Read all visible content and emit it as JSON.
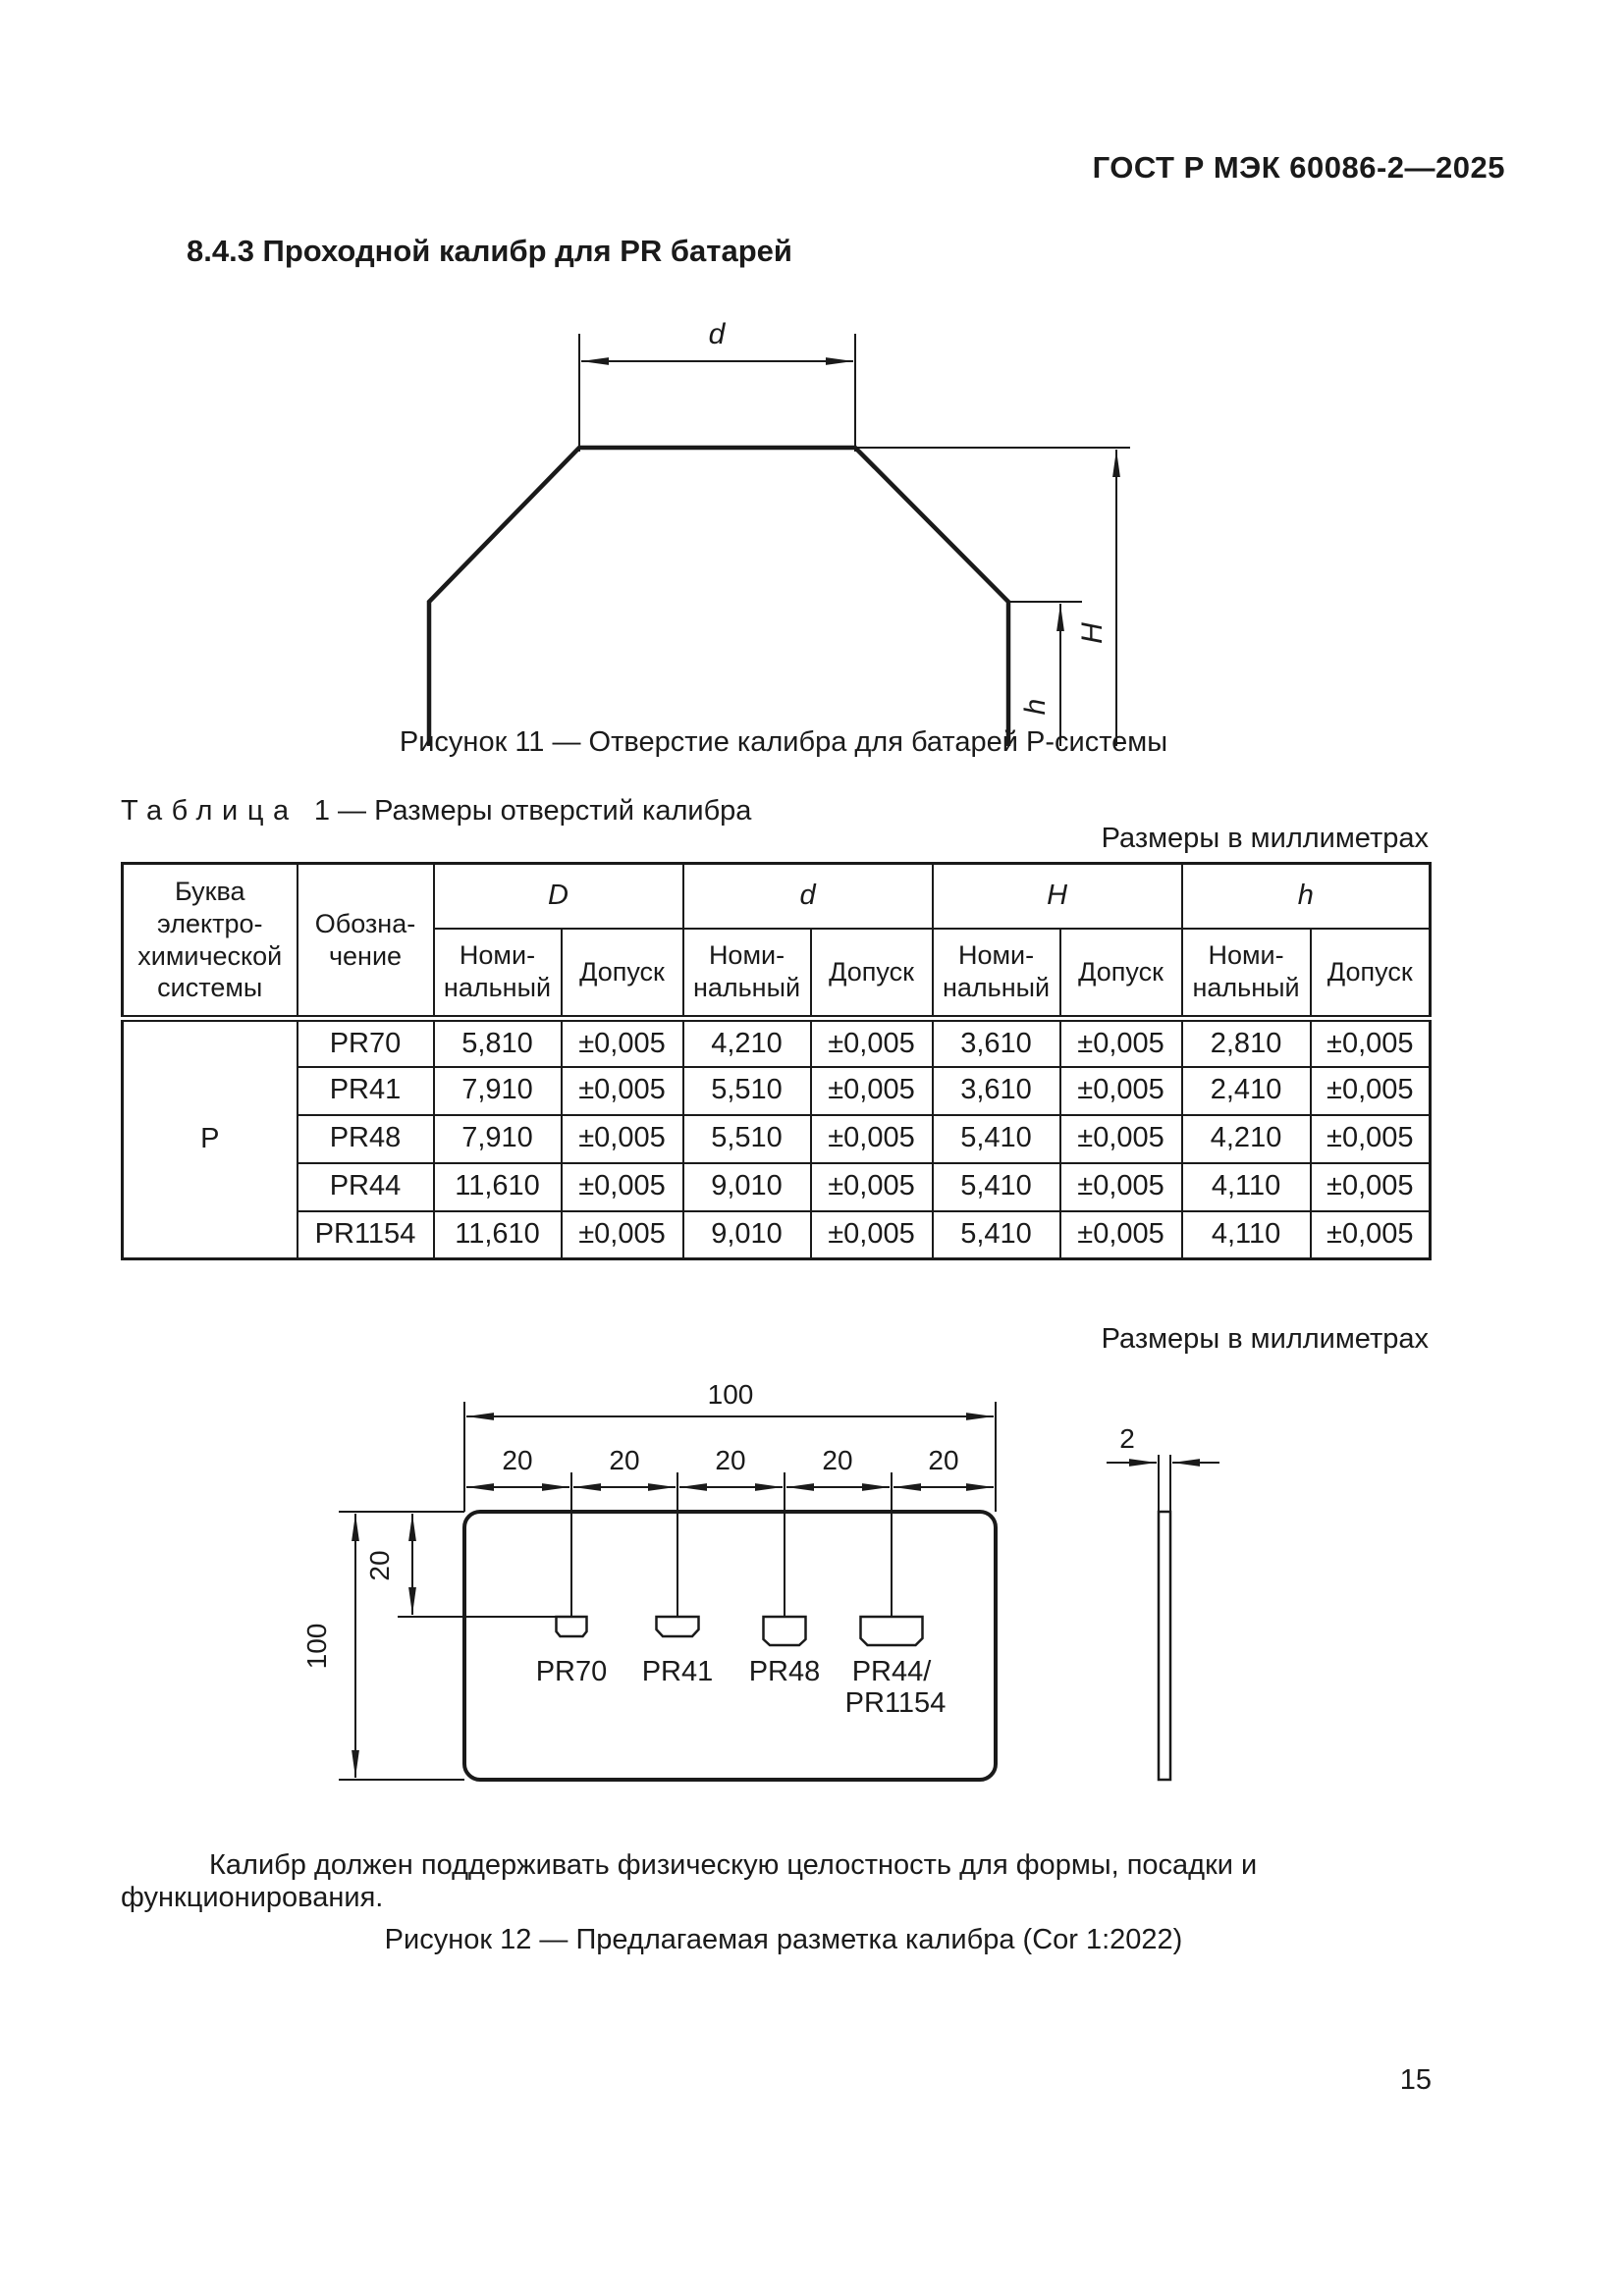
{
  "header": {
    "title": "ГОСТ Р МЭК 60086-2—2025"
  },
  "section": {
    "heading": "8.4.3 Проходной калибр для PR батарей"
  },
  "figure11": {
    "caption": "Рисунок 11 — Отверстие калибра для батарей P-системы",
    "dims": {
      "d": "d",
      "D": "D",
      "H": "H",
      "h": "h"
    }
  },
  "table1": {
    "label": "Таблица",
    "number_and_title": "1 — Размеры отверстий калибра",
    "units_note": "Размеры в миллиметрах",
    "headers": {
      "col_system": "Буква электро-\nхимической\nсистемы",
      "col_designation": "Обозна-\nчение",
      "groups": [
        "D",
        "d",
        "H",
        "h"
      ],
      "nominal": "Номи-\nнальный",
      "tolerance": "Допуск"
    },
    "system_letter": "P",
    "rows": [
      {
        "designation": "PR70",
        "values": [
          "5,810",
          "±0,005",
          "4,210",
          "±0,005",
          "3,610",
          "±0,005",
          "2,810",
          "±0,005"
        ]
      },
      {
        "designation": "PR41",
        "values": [
          "7,910",
          "±0,005",
          "5,510",
          "±0,005",
          "3,610",
          "±0,005",
          "2,410",
          "±0,005"
        ]
      },
      {
        "designation": "PR48",
        "values": [
          "7,910",
          "±0,005",
          "5,510",
          "±0,005",
          "5,410",
          "±0,005",
          "4,210",
          "±0,005"
        ]
      },
      {
        "designation": "PR44",
        "values": [
          "11,610",
          "±0,005",
          "9,010",
          "±0,005",
          "5,410",
          "±0,005",
          "4,110",
          "±0,005"
        ]
      },
      {
        "designation": "PR1154",
        "values": [
          "11,610",
          "±0,005",
          "9,010",
          "±0,005",
          "5,410",
          "±0,005",
          "4,110",
          "±0,005"
        ]
      }
    ]
  },
  "figure12": {
    "units_note": "Размеры в миллиметрах",
    "dim_width_total": "100",
    "dim_steps": [
      "20",
      "20",
      "20",
      "20",
      "20"
    ],
    "dim_height_total": "100",
    "dim_hole_offset": "20",
    "dim_thickness": "2",
    "hole_labels": [
      "PR70",
      "PR41",
      "PR48",
      "PR44/",
      "PR1154"
    ],
    "note": "Калибр должен поддерживать физическую целостность для формы, посадки и функционирования.",
    "caption": "Рисунок 12 — Предлагаемая разметка калибра (Cor 1:2022)"
  },
  "footer": {
    "page_number": "15"
  }
}
